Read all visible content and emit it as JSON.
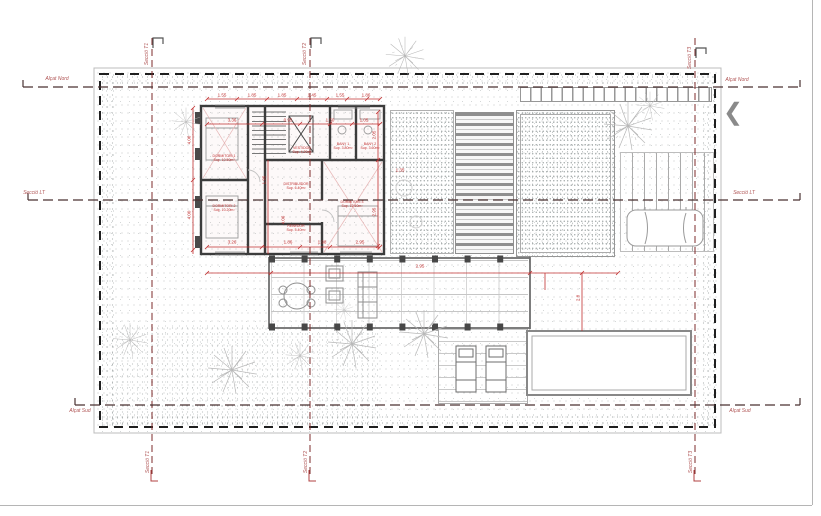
{
  "title": "Planta coberta / emplaçament",
  "nav": {
    "prev_icon": "❮"
  },
  "colors": {
    "dimension_red": "#c03030",
    "axis_dash_red": "#7d2b2b",
    "section_dash": "#4a3232",
    "boundary_black": "#1f1f1f",
    "wall_gray": "#3c3c3c",
    "stipple_gray": "#9ba1a1"
  },
  "axis_labels": [
    {
      "text": "Alçat Nord",
      "x": 57,
      "y": 79
    },
    {
      "text": "Alçat Nord",
      "x": 737,
      "y": 80
    },
    {
      "text": "Secció LT",
      "x": 34,
      "y": 193
    },
    {
      "text": "Secció LT",
      "x": 744,
      "y": 193
    },
    {
      "text": "Alçat Sud",
      "x": 80,
      "y": 411
    },
    {
      "text": "Alçat Sud",
      "x": 740,
      "y": 411
    }
  ],
  "section_labels": [
    {
      "text": "Secció T1",
      "x": 147,
      "y": 54,
      "rot": -90
    },
    {
      "text": "Secció T2",
      "x": 305,
      "y": 54,
      "rot": -90
    },
    {
      "text": "Secció T3",
      "x": 690,
      "y": 58,
      "rot": -90
    },
    {
      "text": "Secció T1",
      "x": 148,
      "y": 462,
      "rot": -90
    },
    {
      "text": "Secció T2",
      "x": 306,
      "y": 462,
      "rot": -90
    },
    {
      "text": "Secció T3",
      "x": 691,
      "y": 462,
      "rot": -90
    }
  ],
  "dimensions": [
    {
      "text": "1.55",
      "x": 222,
      "y": 95
    },
    {
      "text": "1.85",
      "x": 252,
      "y": 95
    },
    {
      "text": "1.85",
      "x": 282,
      "y": 95
    },
    {
      "text": "1.45",
      "x": 312,
      "y": 95
    },
    {
      "text": "1.55",
      "x": 340,
      "y": 95
    },
    {
      "text": "1.86",
      "x": 366,
      "y": 95
    },
    {
      "text": "3.36",
      "x": 232,
      "y": 120
    },
    {
      "text": "0.95",
      "x": 288,
      "y": 120
    },
    {
      "text": "1.50",
      "x": 330,
      "y": 120
    },
    {
      "text": "1.05",
      "x": 364,
      "y": 120
    },
    {
      "text": "3.26",
      "x": 232,
      "y": 242
    },
    {
      "text": "1.86",
      "x": 288,
      "y": 242
    },
    {
      "text": "1.98",
      "x": 322,
      "y": 242
    },
    {
      "text": "2.95",
      "x": 360,
      "y": 242
    },
    {
      "text": "2.95",
      "x": 420,
      "y": 266
    },
    {
      "text": "1.35",
      "x": 400,
      "y": 170
    },
    {
      "text": "4.06",
      "x": 189,
      "y": 140,
      "rot": -90
    },
    {
      "text": "4.00",
      "x": 189,
      "y": 215,
      "rot": -90
    },
    {
      "text": "1.95",
      "x": 264,
      "y": 180,
      "rot": -90
    },
    {
      "text": "4.06",
      "x": 283,
      "y": 220,
      "rot": -90
    },
    {
      "text": "2.05",
      "x": 374,
      "y": 135,
      "rot": -90
    },
    {
      "text": "2.95",
      "x": 374,
      "y": 212,
      "rot": -90
    },
    {
      "text": "2.8",
      "x": 578,
      "y": 298,
      "rot": -90
    }
  ],
  "rooms": [
    {
      "name": "DORMITORI 1",
      "area": "Sup. 10.50m²",
      "x": 224,
      "y": 158
    },
    {
      "name": "DORMITORI 2",
      "area": "Sup. 10.20m²",
      "x": 224,
      "y": 208
    },
    {
      "name": "VESTIDOR",
      "area": "Sup. 4.20m²",
      "x": 302,
      "y": 150
    },
    {
      "name": "BANY 1",
      "area": "Sup. 3.80m²",
      "x": 343,
      "y": 146
    },
    {
      "name": "BANY 2",
      "area": "Sup. 3.60m²",
      "x": 370,
      "y": 146
    },
    {
      "name": "DISTRIBUÏDOR",
      "area": "Sup. 6.40m²",
      "x": 296,
      "y": 186
    },
    {
      "name": "DORMITORI 3",
      "area": "Sup. 12.60m²",
      "x": 352,
      "y": 204
    },
    {
      "name": "REBEDOR",
      "area": "Sup. 5.40m²",
      "x": 296,
      "y": 228
    }
  ],
  "trees": [
    {
      "x": 405,
      "y": 56,
      "s": 0.8
    },
    {
      "x": 628,
      "y": 126,
      "s": 1.0
    },
    {
      "x": 650,
      "y": 106,
      "s": 0.6
    },
    {
      "x": 186,
      "y": 122,
      "s": 0.6
    },
    {
      "x": 232,
      "y": 370,
      "s": 1.0
    },
    {
      "x": 300,
      "y": 356,
      "s": 0.6
    },
    {
      "x": 352,
      "y": 344,
      "s": 1.0
    },
    {
      "x": 424,
      "y": 334,
      "s": 1.0
    },
    {
      "x": 344,
      "y": 310,
      "s": 0.4
    },
    {
      "x": 130,
      "y": 340,
      "s": 0.7
    }
  ]
}
